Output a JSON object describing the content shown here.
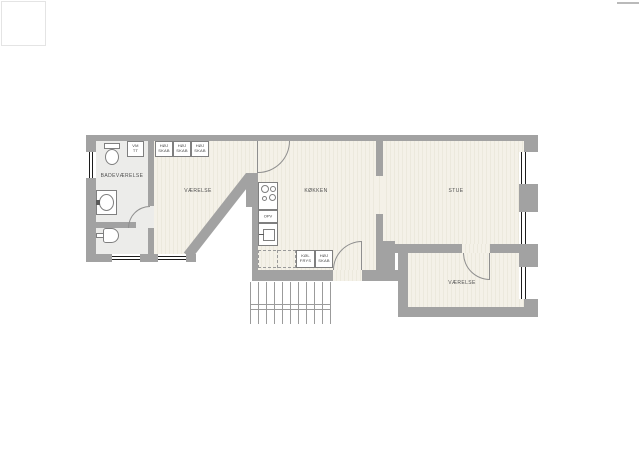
{
  "document": {
    "type": "apartment floor plan"
  },
  "colors": {
    "wall": "#a2a2a2",
    "floor": "#f4f1e8",
    "floor_stripe": "#ece9dd",
    "floor_bath": "#ececea",
    "outline": "#7f7f7f",
    "window_line": "#1c1c1c",
    "arc": "#8f8f8f",
    "label": "#4f4f4f"
  },
  "labels": {
    "bathroom": "BADEVÆRELSE",
    "bedroom_left": "VÆRELSE",
    "kitchen": "KØKKEN",
    "living_room": "STUE",
    "bedroom_right": "VÆRELSE",
    "washer_dryer": {
      "l1": "VM",
      "l2": "TT"
    },
    "tall_cabinet": {
      "l1": "HØJ",
      "l2": "SKAB"
    },
    "dishwasher": "OPV",
    "fridge_freezer": {
      "l1": "KØL",
      "l2": "FRYS"
    }
  }
}
